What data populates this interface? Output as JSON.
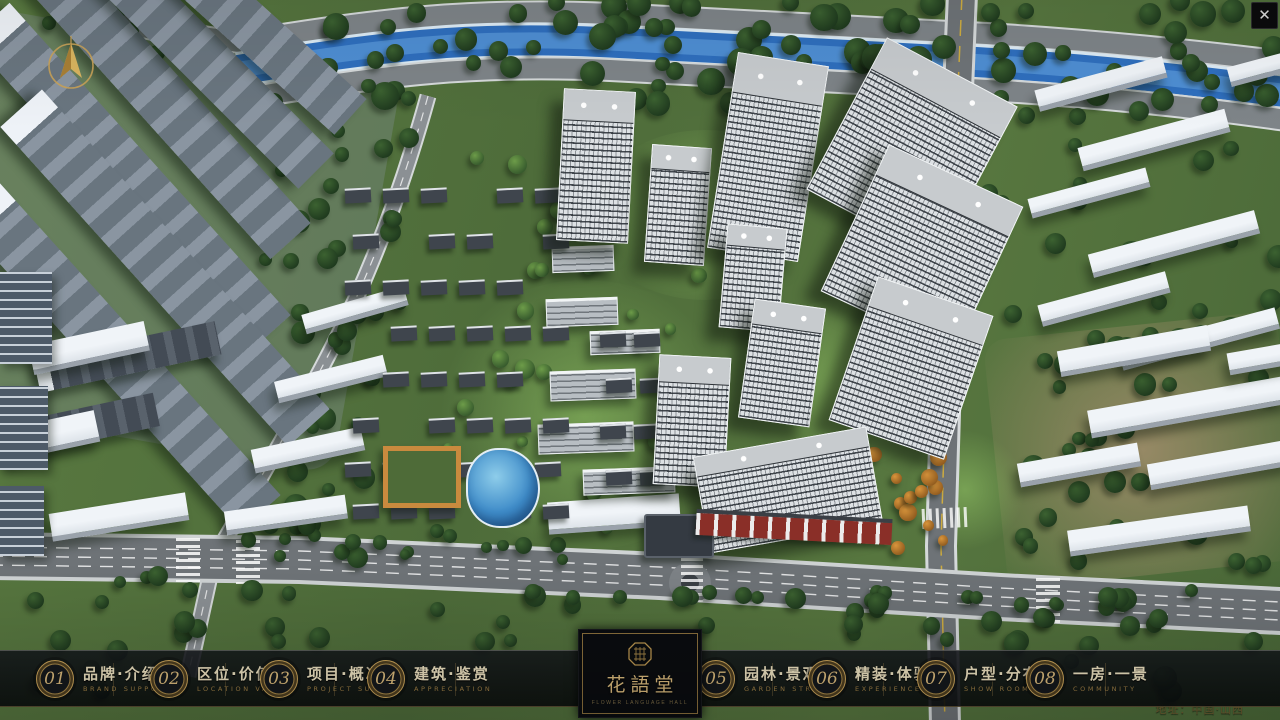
{
  "window": {
    "close_icon": "✕"
  },
  "map": {
    "address": "地址：中国·山西"
  },
  "nav": {
    "items": [
      {
        "num": "01",
        "zh": "品牌·介绍",
        "en": "BRAND SUPPORT"
      },
      {
        "num": "02",
        "zh": "区位·价值",
        "en": "LOCATION VALUE"
      },
      {
        "num": "03",
        "zh": "项目·概况",
        "en": "PROJECT SURVEY"
      },
      {
        "num": "04",
        "zh": "建筑·鉴赏",
        "en": "APPRECIATION"
      },
      {
        "num": "05",
        "zh": "园林·景观",
        "en": "GARDEN STREET"
      },
      {
        "num": "06",
        "zh": "精装·体验",
        "en": "EXPERIENCE"
      },
      {
        "num": "07",
        "zh": "户型·分布",
        "en": "SHOW ROOM"
      },
      {
        "num": "08",
        "zh": "一房·一景",
        "en": "COMMUNITY"
      }
    ],
    "logo": {
      "title": "花語堂",
      "subtitle": "FLOWER LANGUAGE HALL"
    }
  },
  "colors": {
    "gold": "#c9a258",
    "gold_text": "#eadfbe",
    "gold_dim": "#9c7c44",
    "bar_bg": "#0b0d10",
    "river": "#2f6fbe",
    "grass": "#55743d"
  }
}
